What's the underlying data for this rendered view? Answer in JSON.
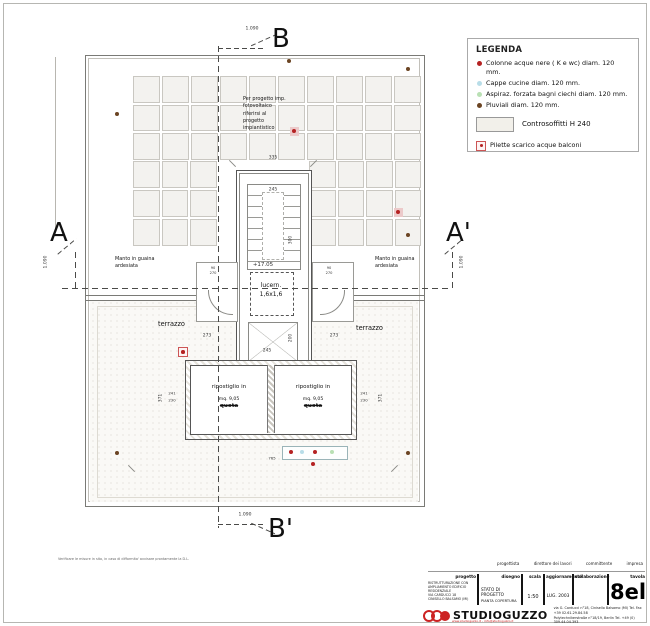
{
  "colors": {
    "red": "#b52222",
    "blue": "#b8dde8",
    "green": "#b9e0b4",
    "brown": "#6b4423",
    "accent": "#cc2222"
  },
  "legend": {
    "title": "LEGENDA",
    "items": [
      {
        "icon": "dot-red",
        "color": "red",
        "label": "Colonne acque nere ( K e wc) diam. 120 mm."
      },
      {
        "icon": "dot-blue",
        "color": "blue",
        "label": "Cappe cucine diam. 120 mm."
      },
      {
        "icon": "dot-green",
        "color": "green",
        "label": "Aspiraz. forzata bagni ciechi diam. 120 mm."
      },
      {
        "icon": "dot-brown",
        "color": "brown",
        "label": "Pluviali diam. 120 mm."
      }
    ],
    "ceiling_label": "Controsoffitti H 240",
    "pilette_label": "Pilette scarico acque balconi"
  },
  "plan": {
    "sections": {
      "a": "A",
      "a1": "A'",
      "b": "B",
      "b1": "B'"
    },
    "note": "Per progetto imp.\nfotovoltaico\nriferirsi al\nprogetto\nimpiantistico",
    "manto_left": "Manto in guaina\nardesiata",
    "manto_right": "Manto in guaina\nardesiata",
    "terrazzo_left": "terrazzo",
    "terrazzo_right": "terrazzo",
    "skylight": "lucern.\n1,6x1,6",
    "room_left": {
      "l1": "ripostiglio in",
      "l2": "mq. 9,05",
      "l3": "quota"
    },
    "room_right": {
      "l1": "ripostiglio in",
      "l2": "mq. 9,05",
      "l3": "quota"
    },
    "footnote": "Verificare le misure in sito, in caso di difformita' avvisare prontamente la D.L.",
    "solar_grid": {
      "band": {
        "cols": 10,
        "rows": 3
      },
      "left": {
        "cols": 3,
        "rows": 3
      },
      "right": {
        "cols": 4,
        "rows": 3
      }
    },
    "dims": [
      {
        "v": "1.090",
        "x": 252,
        "y": 29
      },
      {
        "v": "1.090",
        "x": 245,
        "y": 515
      },
      {
        "v": "1.090",
        "x": 46,
        "y": 262,
        "rot": 1
      },
      {
        "v": "1.090",
        "x": 462,
        "y": 262,
        "rot": 1
      },
      {
        "v": "335",
        "x": 273,
        "y": 158
      },
      {
        "v": "245",
        "x": 273,
        "y": 190
      },
      {
        "v": "300",
        "x": 291,
        "y": 240,
        "rot": 1
      },
      {
        "v": "200",
        "x": 291,
        "y": 338,
        "rot": 1
      },
      {
        "v": "+17.05",
        "x": 263,
        "y": 265,
        "fs": 5.5
      },
      {
        "v": "90",
        "x": 213,
        "y": 268,
        "fs": 3.6
      },
      {
        "v": "270",
        "x": 213,
        "y": 273,
        "fs": 3.6
      },
      {
        "v": "90",
        "x": 329,
        "y": 268,
        "fs": 3.6
      },
      {
        "v": "270",
        "x": 329,
        "y": 273,
        "fs": 3.6
      },
      {
        "v": "273",
        "x": 207,
        "y": 336
      },
      {
        "v": "273",
        "x": 334,
        "y": 336
      },
      {
        "v": "245",
        "x": 267,
        "y": 351
      },
      {
        "v": "371",
        "x": 161,
        "y": 398,
        "rot": 1
      },
      {
        "v": "371",
        "x": 381,
        "y": 398,
        "rot": 1
      },
      {
        "v": "241",
        "x": 172,
        "y": 393,
        "fs": 3.8
      },
      {
        "v": "230",
        "x": 172,
        "y": 400,
        "fs": 3.8
      },
      {
        "v": "241",
        "x": 364,
        "y": 393,
        "fs": 3.8
      },
      {
        "v": "230",
        "x": 364,
        "y": 400,
        "fs": 3.8
      },
      {
        "v": "765",
        "x": 272,
        "y": 458,
        "fs": 3.8
      }
    ],
    "markers": [
      {
        "t": "red-halo",
        "x": 294,
        "y": 131
      },
      {
        "t": "red-halo",
        "x": 398,
        "y": 212
      },
      {
        "t": "pilette",
        "x": 182,
        "y": 351
      },
      {
        "t": "red",
        "x": 291,
        "y": 452
      },
      {
        "t": "blue",
        "x": 302,
        "y": 452
      },
      {
        "t": "red",
        "x": 315,
        "y": 452
      },
      {
        "t": "green",
        "x": 332,
        "y": 452
      },
      {
        "t": "red",
        "x": 313,
        "y": 464
      },
      {
        "t": "brown",
        "x": 117,
        "y": 114
      },
      {
        "t": "brown",
        "x": 289,
        "y": 61
      },
      {
        "t": "brown",
        "x": 408,
        "y": 69
      },
      {
        "t": "brown",
        "x": 408,
        "y": 235
      },
      {
        "t": "brown",
        "x": 117,
        "y": 453
      },
      {
        "t": "brown",
        "x": 408,
        "y": 453
      },
      {
        "t": "tick",
        "x": 232,
        "y": 163
      },
      {
        "t": "tick2",
        "x": 313,
        "y": 163
      },
      {
        "t": "tick",
        "x": 131,
        "y": 468
      },
      {
        "t": "tick2",
        "x": 394,
        "y": 468
      }
    ]
  },
  "titleblock": {
    "roles": [
      "progettista",
      "direttore dei lavori",
      "committente",
      "impresa"
    ],
    "progetto_label": "progetto",
    "progetto_lines": [
      "RISTRUTTURAZIONE CON",
      "AMPLIAMENTO EDIFICIO",
      "RESIDENZIALE",
      "VIA CARDUCCI 18",
      "CINISELLO BALSAMO (MI)"
    ],
    "disegno_label": "disegno",
    "disegno_line1": "STATO DI PROGETTO",
    "disegno_line2": "PIANTA COPERTURA",
    "scala_label": "scala",
    "scala_value": "1:50",
    "agg_label": "aggiornamento",
    "agg_value": "LUG. 2003",
    "collab_label": "collaborazione",
    "tavola_label": "tavola",
    "tavola_value": "8el",
    "logo_name": "STUDIOGUZZO",
    "logo_url": "www.studioguzzo.it - info@studioguzzo.it",
    "address": "via G. Carducci n°18, Cinisello Balsamo (MI)   Tel. Fax +39 02.61.29.84.58\nPolytechnikerstraße n°18/19, Berlin   Tel. +49 (0) 309.44.04.393"
  }
}
